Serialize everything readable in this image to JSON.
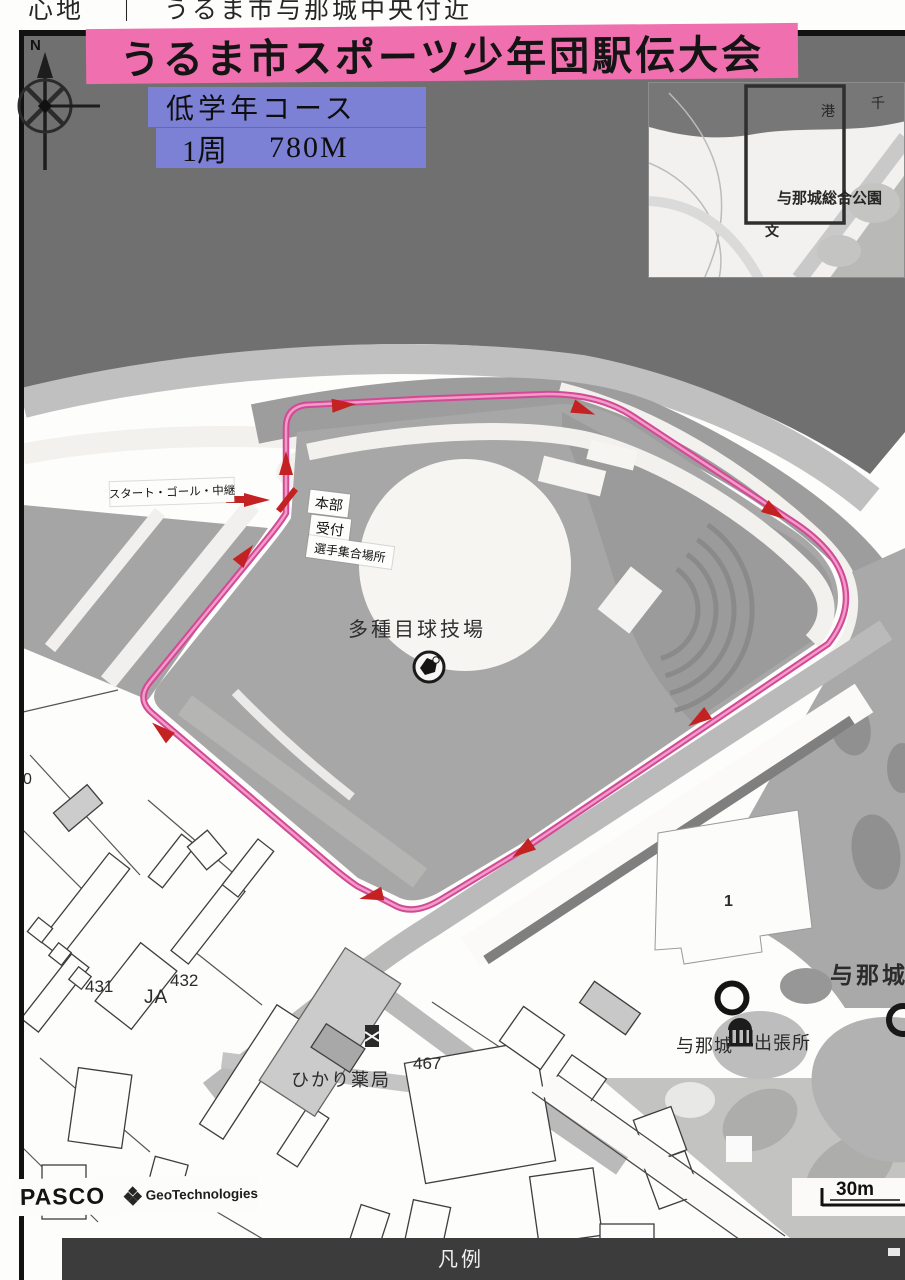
{
  "header": {
    "prefix": "心地",
    "separator": "｜",
    "title": "うるま市与那城中央付近"
  },
  "banner": {
    "title": "うるま市スポーツ少年団駅伝大会"
  },
  "course_info": {
    "name": "低学年コース",
    "lap": "1周",
    "distance": "780M"
  },
  "compass": {
    "north": "N"
  },
  "inset_map": {
    "harbor": "港",
    "sen": "千",
    "park_name": "与那城総合公園",
    "school_mark": "文"
  },
  "course_labels": {
    "start_goal_relay": "スタート・ゴール・中継",
    "headquarters": "本部",
    "reception": "受付",
    "assembly_area": "選手集合場所"
  },
  "map_labels": {
    "stadium": "多種目球技場",
    "number_431": "431",
    "number_432": "432",
    "ja": "JA",
    "number_467": "467",
    "number_0": "0",
    "pharmacy": "ひかり薬局",
    "branch_office_prefix": "与那城",
    "branch_office_suffix": "出張所",
    "district": "与那城",
    "building_1": "1"
  },
  "footer": {
    "pasco": "PASCO",
    "geotechnologies": "GeoTechnologies",
    "scale": "30m",
    "legend": "凡例"
  },
  "colors": {
    "banner_pink": "#f06fae",
    "course_box_blue": "#7c81d6",
    "course_pink": "#d14a95",
    "arrow_red": "#c42222"
  }
}
